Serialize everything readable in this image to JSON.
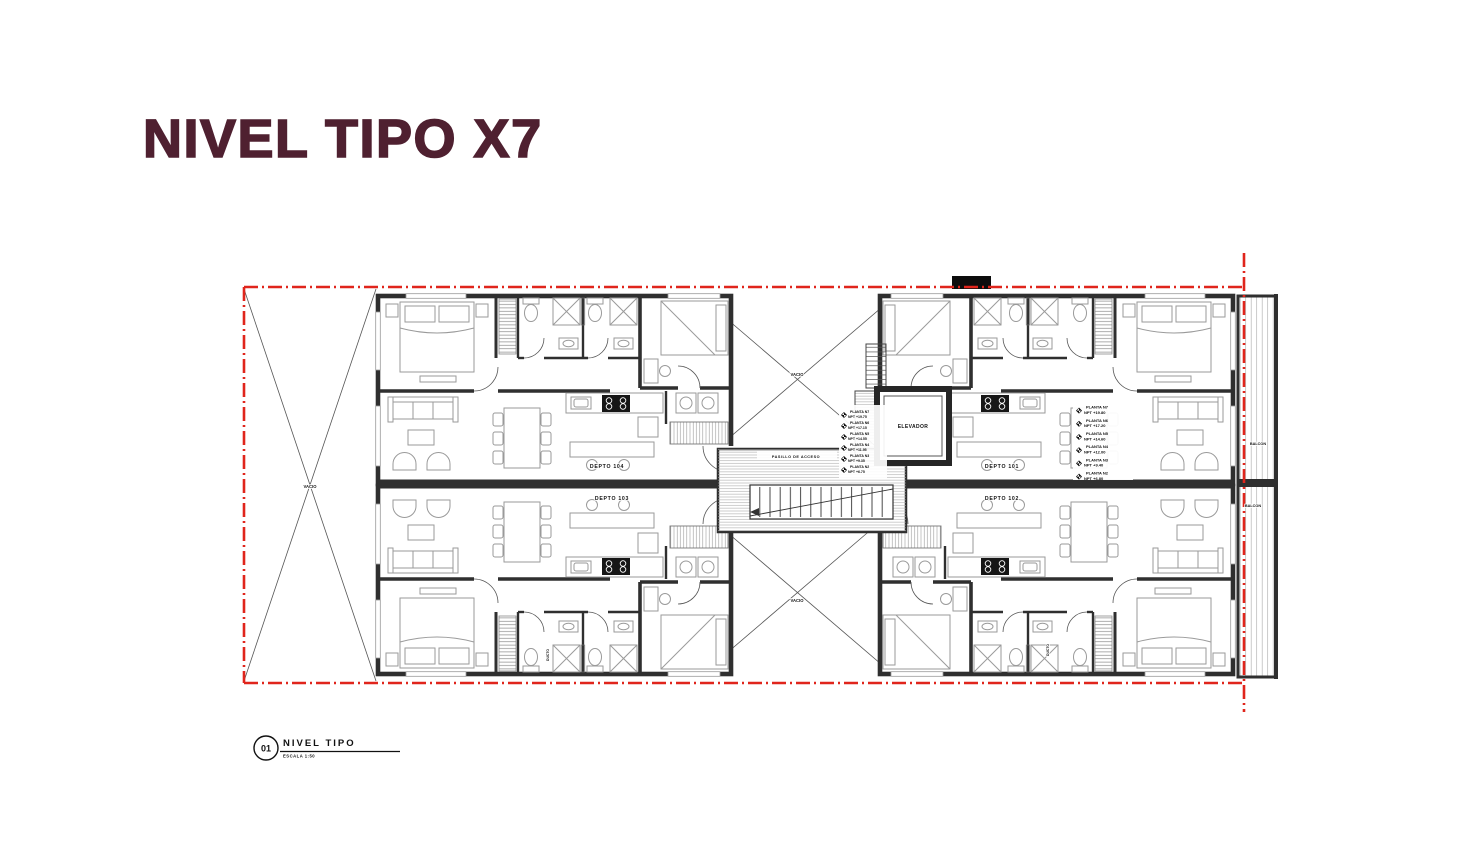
{
  "title": "NIVEL TIPO X7",
  "colors": {
    "title_maroon": "#4f2030",
    "boundary_red": "#e0251c",
    "wall_dark": "#2f2f2f",
    "furniture_gray": "#9a9a9a"
  },
  "plan": {
    "apartments": [
      {
        "label": "DEPTO 104"
      },
      {
        "label": "DEPTO 103"
      },
      {
        "label": "DEPTO 101"
      },
      {
        "label": "DEPTO 102"
      }
    ],
    "elevator_label": "ELEVADOR",
    "corridor_label": "PASILLO DE ACCESO",
    "void_label": "VACIO",
    "balcony_label": "BALCON",
    "duct_label": "DUCTO",
    "levels_right": [
      {
        "planta": "PLANTA N7",
        "npt": "NPT +19.80"
      },
      {
        "planta": "PLANTA N6",
        "npt": "NPT +17.20"
      },
      {
        "planta": "PLANTA N5",
        "npt": "NPT +14.60"
      },
      {
        "planta": "PLANTA N4",
        "npt": "NPT +12.00"
      },
      {
        "planta": "PLANTA N3",
        "npt": "NPT +9.40"
      },
      {
        "planta": "PLANTA N2",
        "npt": "NPT +6.80"
      }
    ],
    "levels_left": [
      {
        "planta": "PLANTA N7",
        "npt": "NPT +19.75"
      },
      {
        "planta": "PLANTA N6",
        "npt": "NPT +17.15"
      },
      {
        "planta": "PLANTA N5",
        "npt": "NPT +14.55"
      },
      {
        "planta": "PLANTA N4",
        "npt": "NPT +11.95"
      },
      {
        "planta": "PLANTA N3",
        "npt": "NPT +9.35"
      },
      {
        "planta": "PLANTA N2",
        "npt": "NPT +6.75"
      }
    ]
  },
  "view_tag": {
    "number": "01",
    "name": "NIVEL TIPO",
    "scale": "ESCALA 1:50"
  }
}
